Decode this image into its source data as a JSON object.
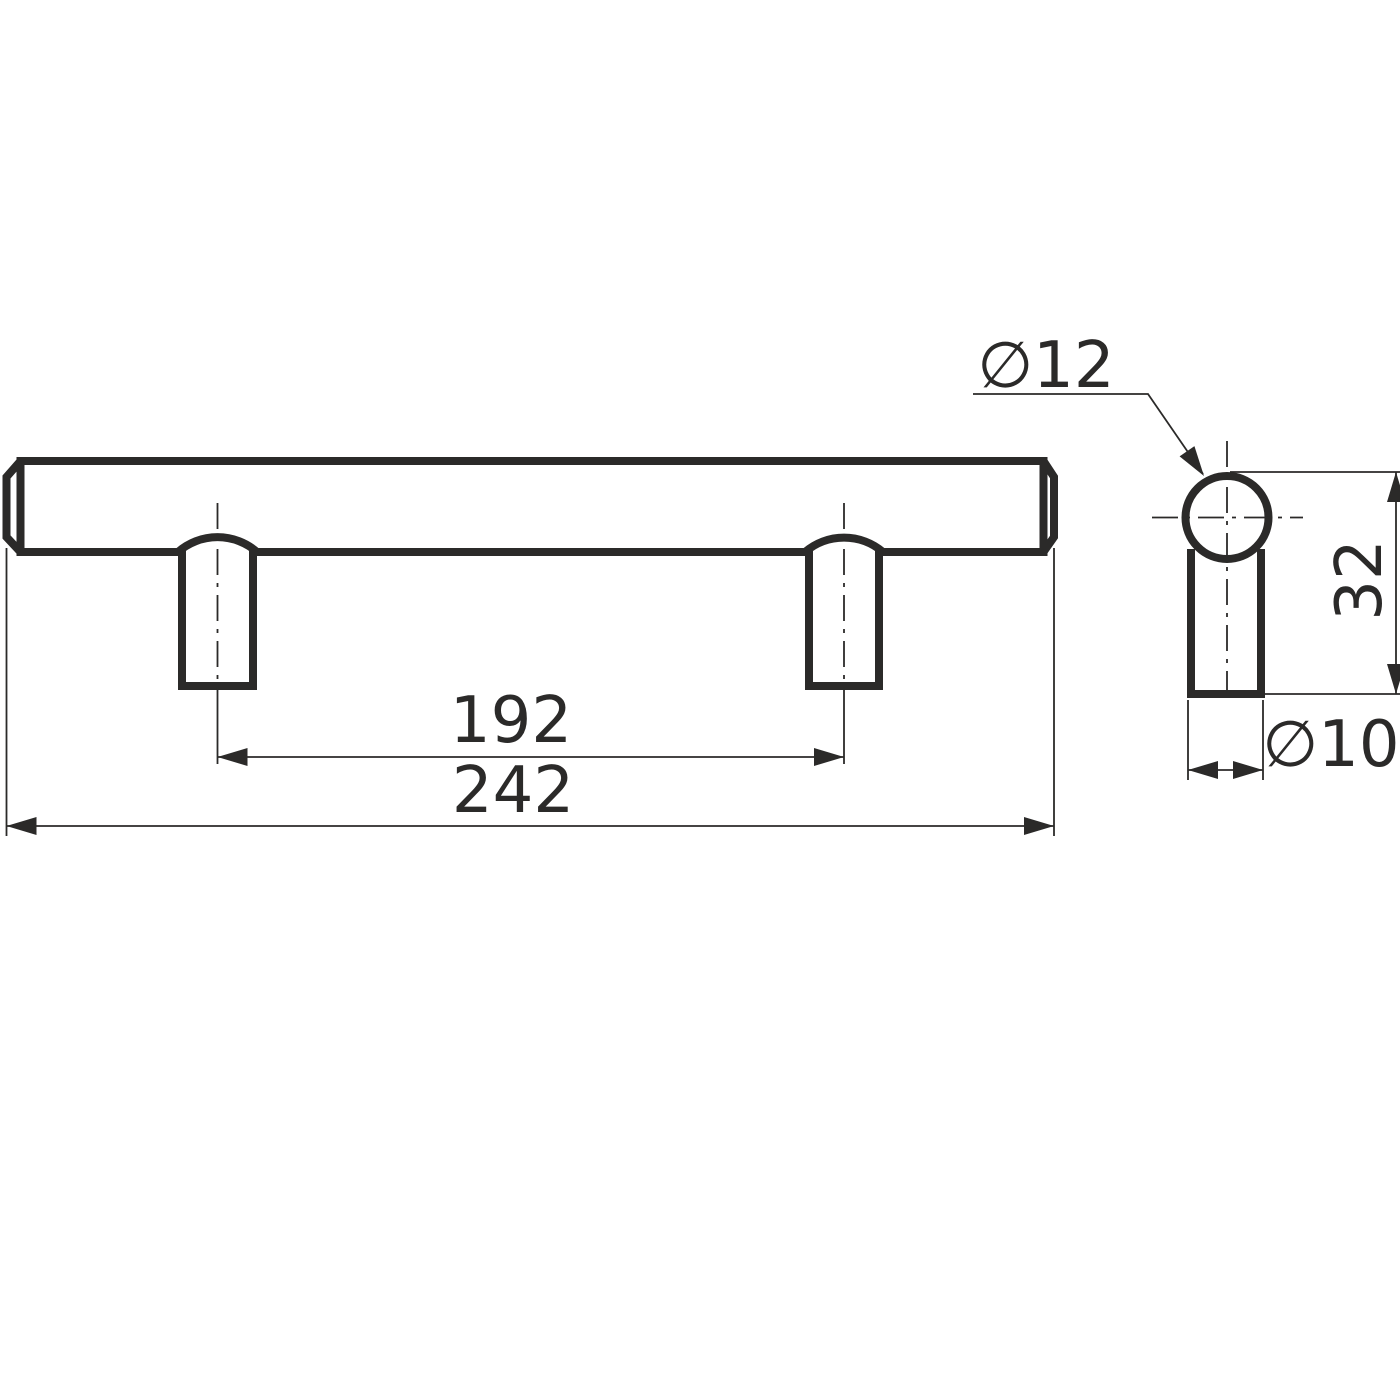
{
  "drawing": {
    "kind": "technical-dimension-drawing",
    "subject": "bar-handle-with-two-posts",
    "background": "#ffffff",
    "line_color": "#2b2a29",
    "views": {
      "front": {
        "dimensions": {
          "hole_spacing": {
            "label": "192",
            "value": 192
          },
          "overall_length": {
            "label": "242",
            "value": 242
          }
        }
      },
      "side": {
        "dimensions": {
          "bar_diameter": {
            "label": "∅12",
            "value": 12
          },
          "height": {
            "label": "32",
            "value": 32
          },
          "post_diameter": {
            "label": "∅10",
            "value": 10
          }
        }
      }
    }
  }
}
